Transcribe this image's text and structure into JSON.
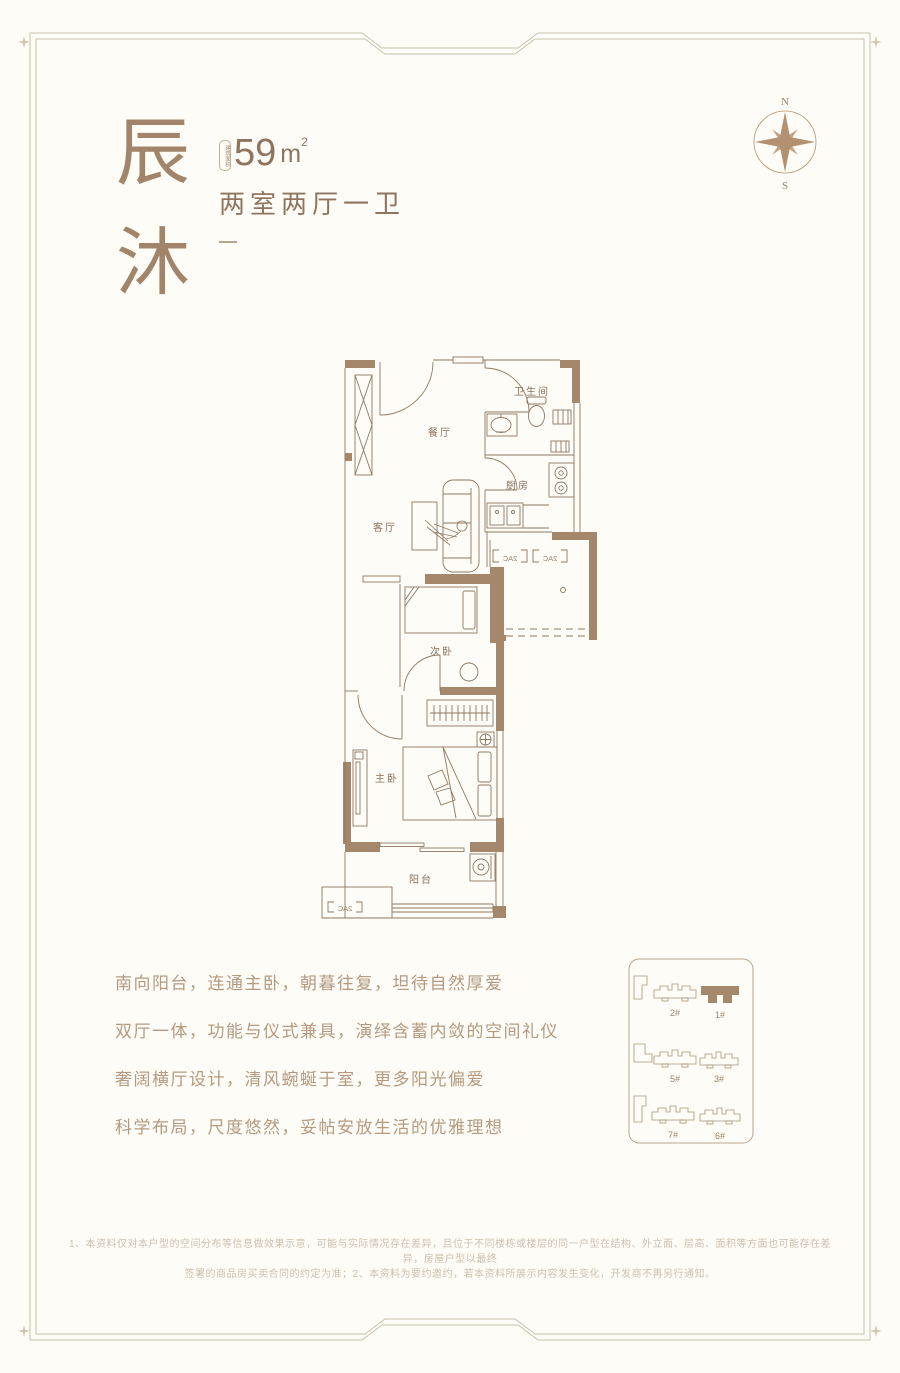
{
  "colors": {
    "background": "#fdfcf6",
    "frame_line": "#c9c0af",
    "wall_brown": "#a5876b",
    "plan_line": "#8f7864",
    "accent_text": "#8f7560",
    "title_text": "#a1846a",
    "description_text": "#b49a81",
    "disclaimer_text": "#cdbfae"
  },
  "header": {
    "title_char_1": "辰",
    "title_char_2": "沐",
    "area_badge_label": "建筑面积",
    "area_value": "59",
    "area_unit": "m",
    "area_exponent": "2",
    "layout_label": "两室两厅一卫"
  },
  "compass": {
    "north_label": "N",
    "south_label": "S"
  },
  "floor_plan": {
    "rooms": [
      {
        "name": "餐厅"
      },
      {
        "name": "卫生间"
      },
      {
        "name": "厨房"
      },
      {
        "name": "客厅"
      },
      {
        "name": "次卧"
      },
      {
        "name": "主卧"
      },
      {
        "name": "阳台"
      }
    ],
    "ac_unit_label": "2AC"
  },
  "descriptions": [
    "南向阳台，连通主卧，朝暮往复，坦待自然厚爱",
    "双厅一体，功能与仪式兼具，演绎含蓄内敛的空间礼仪",
    "奢阔横厅设计，清风蜿蜒于室，更多阳光偏爱",
    "科学布局，尺度悠然，妥帖安放生活的优雅理想"
  ],
  "site_plan": {
    "buildings": [
      {
        "label": "2#",
        "highlighted": false
      },
      {
        "label": "1#",
        "highlighted": true
      },
      {
        "label": "5#",
        "highlighted": false
      },
      {
        "label": "3#",
        "highlighted": false
      },
      {
        "label": "7#",
        "highlighted": false
      },
      {
        "label": "6#",
        "highlighted": false
      }
    ]
  },
  "disclaimer": {
    "line_1": "1、本资料仅对本户型的空间分布等信息做效果示意，可能与实际情况存在差异，且位于不同楼栋或楼层的同一户型在结构、外立面、层高、面积等方面也可能存在差异，房屋户型以最终",
    "line_2": "签署的商品房买卖合同的约定为准；2、本资料为要约邀约，若本资料所展示内容发生变化，开发商不再另行通知。"
  }
}
